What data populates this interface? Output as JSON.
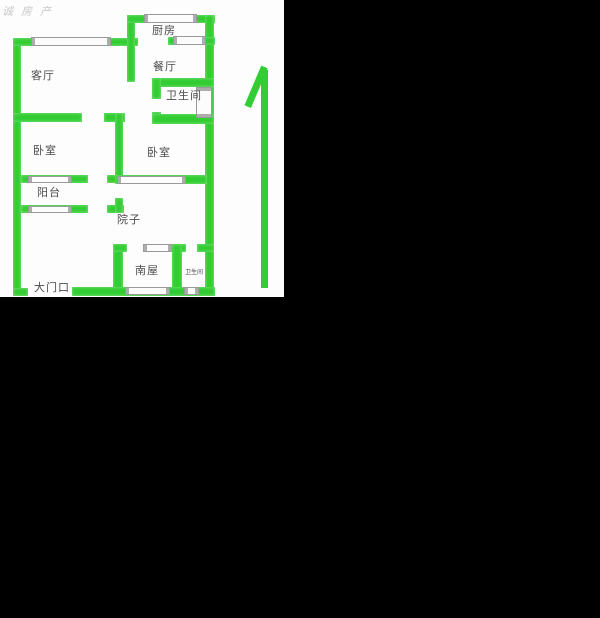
{
  "watermark": "诚房产",
  "colors": {
    "background": "#000000",
    "paper": "#fdfdfd",
    "wall_green": "#32cd32",
    "window_border": "#9a9a9a",
    "label_text": "#4b4b4b",
    "watermark_text": "#c9c9c9"
  },
  "rooms": {
    "kitchen": "厨房",
    "living_room": "客厅",
    "dining_room": "餐厅",
    "bathroom": "卫生间",
    "bedroom_left": "卧室",
    "bedroom_right": "卧室",
    "balcony": "阳台",
    "courtyard": "院子",
    "south_room": "南屋",
    "small_bathroom": "卫生间",
    "entrance": "大门口"
  },
  "compass": {
    "meaning": "north-arrow"
  }
}
